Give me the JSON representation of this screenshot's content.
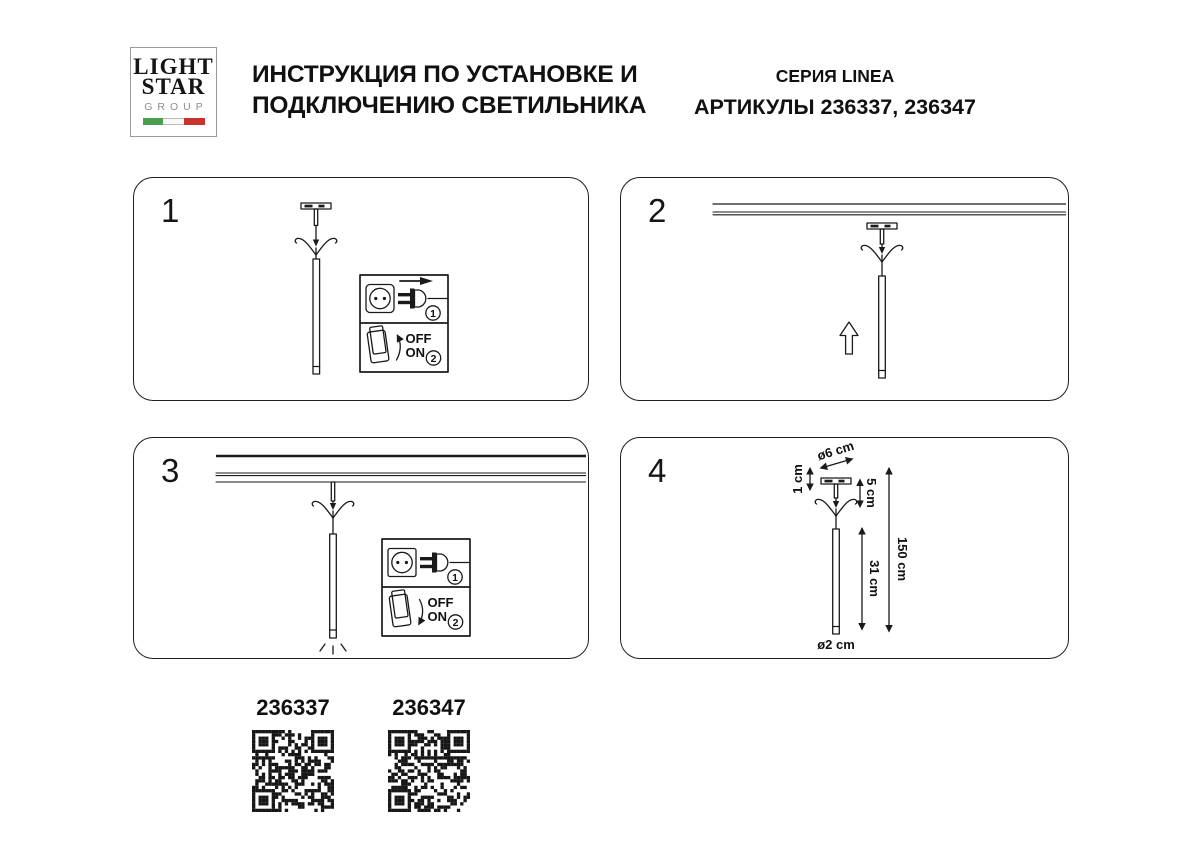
{
  "header": {
    "logo": {
      "line1": "LIGHT",
      "line2": "STAR",
      "line3": "GROUP"
    },
    "title_line1": "ИНСТРУКЦИЯ ПО УСТАНОВКЕ И",
    "title_line2": "ПОДКЛЮЧЕНИЮ СВЕТИЛЬНИКА",
    "series": "СЕРИЯ LINEA",
    "articles": "АРТИКУЛЫ 236337, 236347"
  },
  "panels": [
    {
      "number": "1"
    },
    {
      "number": "2"
    },
    {
      "number": "3"
    },
    {
      "number": "4"
    }
  ],
  "inset": {
    "off": "OFF",
    "on": "ON",
    "step1": "1",
    "step2": "2"
  },
  "dimensions": {
    "canopy_diameter": "ø6 cm",
    "canopy_height": "1 cm",
    "suspension": "5 cm",
    "total_height": "150 cm",
    "tube_length": "31 cm",
    "tube_diameter": "ø2 cm"
  },
  "footer": {
    "articles": [
      {
        "code": "236337"
      },
      {
        "code": "236347"
      }
    ]
  },
  "colors": {
    "ink": "#1a1a1a",
    "flag_green": "#4a9e4f",
    "flag_white": "#f7f7f4",
    "flag_red": "#c8322f"
  }
}
